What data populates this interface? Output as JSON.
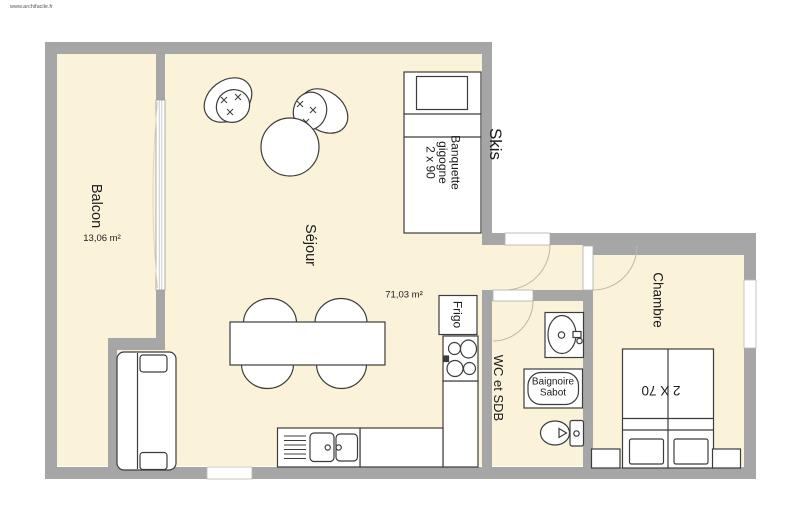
{
  "watermark": "www.archifacile.fr",
  "plan": {
    "rooms": {
      "balcon": {
        "name": "Balcon",
        "area": "13,06 m²"
      },
      "sejour": {
        "name": "Séjour",
        "area": "71,03 m²"
      },
      "chambre": {
        "name": "Chambre"
      },
      "wc_sdb": {
        "name": "WC et SDB"
      },
      "skis": {
        "name": "Skis"
      }
    },
    "furniture": {
      "banquette_line1": "Banquette",
      "banquette_line2": "gigogne",
      "banquette_line3": "2 x 90",
      "frigo": "Frigo",
      "baignoire_line1": "Baignoire",
      "baignoire_line2": "Sabot",
      "double_bed": "2 X 70"
    },
    "colors": {
      "room_fill": "#faf3da",
      "wall": "#a6a6a6",
      "outline": "#3c3c3c"
    }
  }
}
